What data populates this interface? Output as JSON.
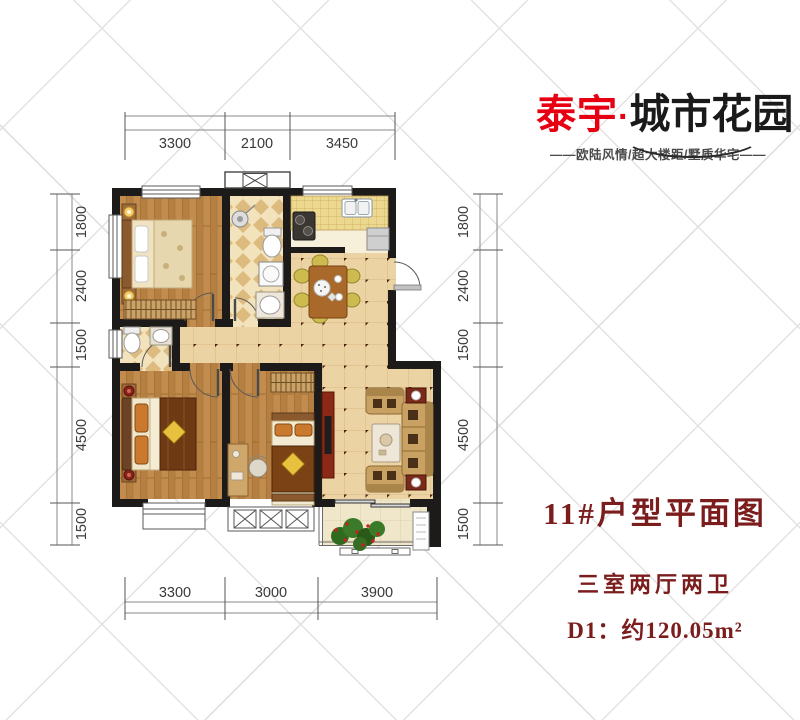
{
  "logo": {
    "brand": "泰宇",
    "separator": "·",
    "name": "城市花园",
    "tagline": "——欧陆风情/超大楼距/墅质华宅——"
  },
  "info": {
    "title": "11#户型平面图",
    "rooms": "三室两厅两卫",
    "area": "D1：约120.05m²"
  },
  "dims": {
    "top": [
      "3300",
      "2100",
      "3450"
    ],
    "bottom": [
      "3300",
      "3000",
      "3900"
    ],
    "left": [
      "1800",
      "2400",
      "1500",
      "4500",
      "1500"
    ],
    "right": [
      "1800",
      "2400",
      "1500",
      "4500",
      "1500"
    ]
  },
  "colors": {
    "brand_red": "#e60012",
    "title_red": "#7b1d1d",
    "wall": "#1d1b1a",
    "wood_floor": "#c08a4e",
    "tile_floor": "#ecd3a4",
    "bath_tile": "#f2e3bd"
  }
}
